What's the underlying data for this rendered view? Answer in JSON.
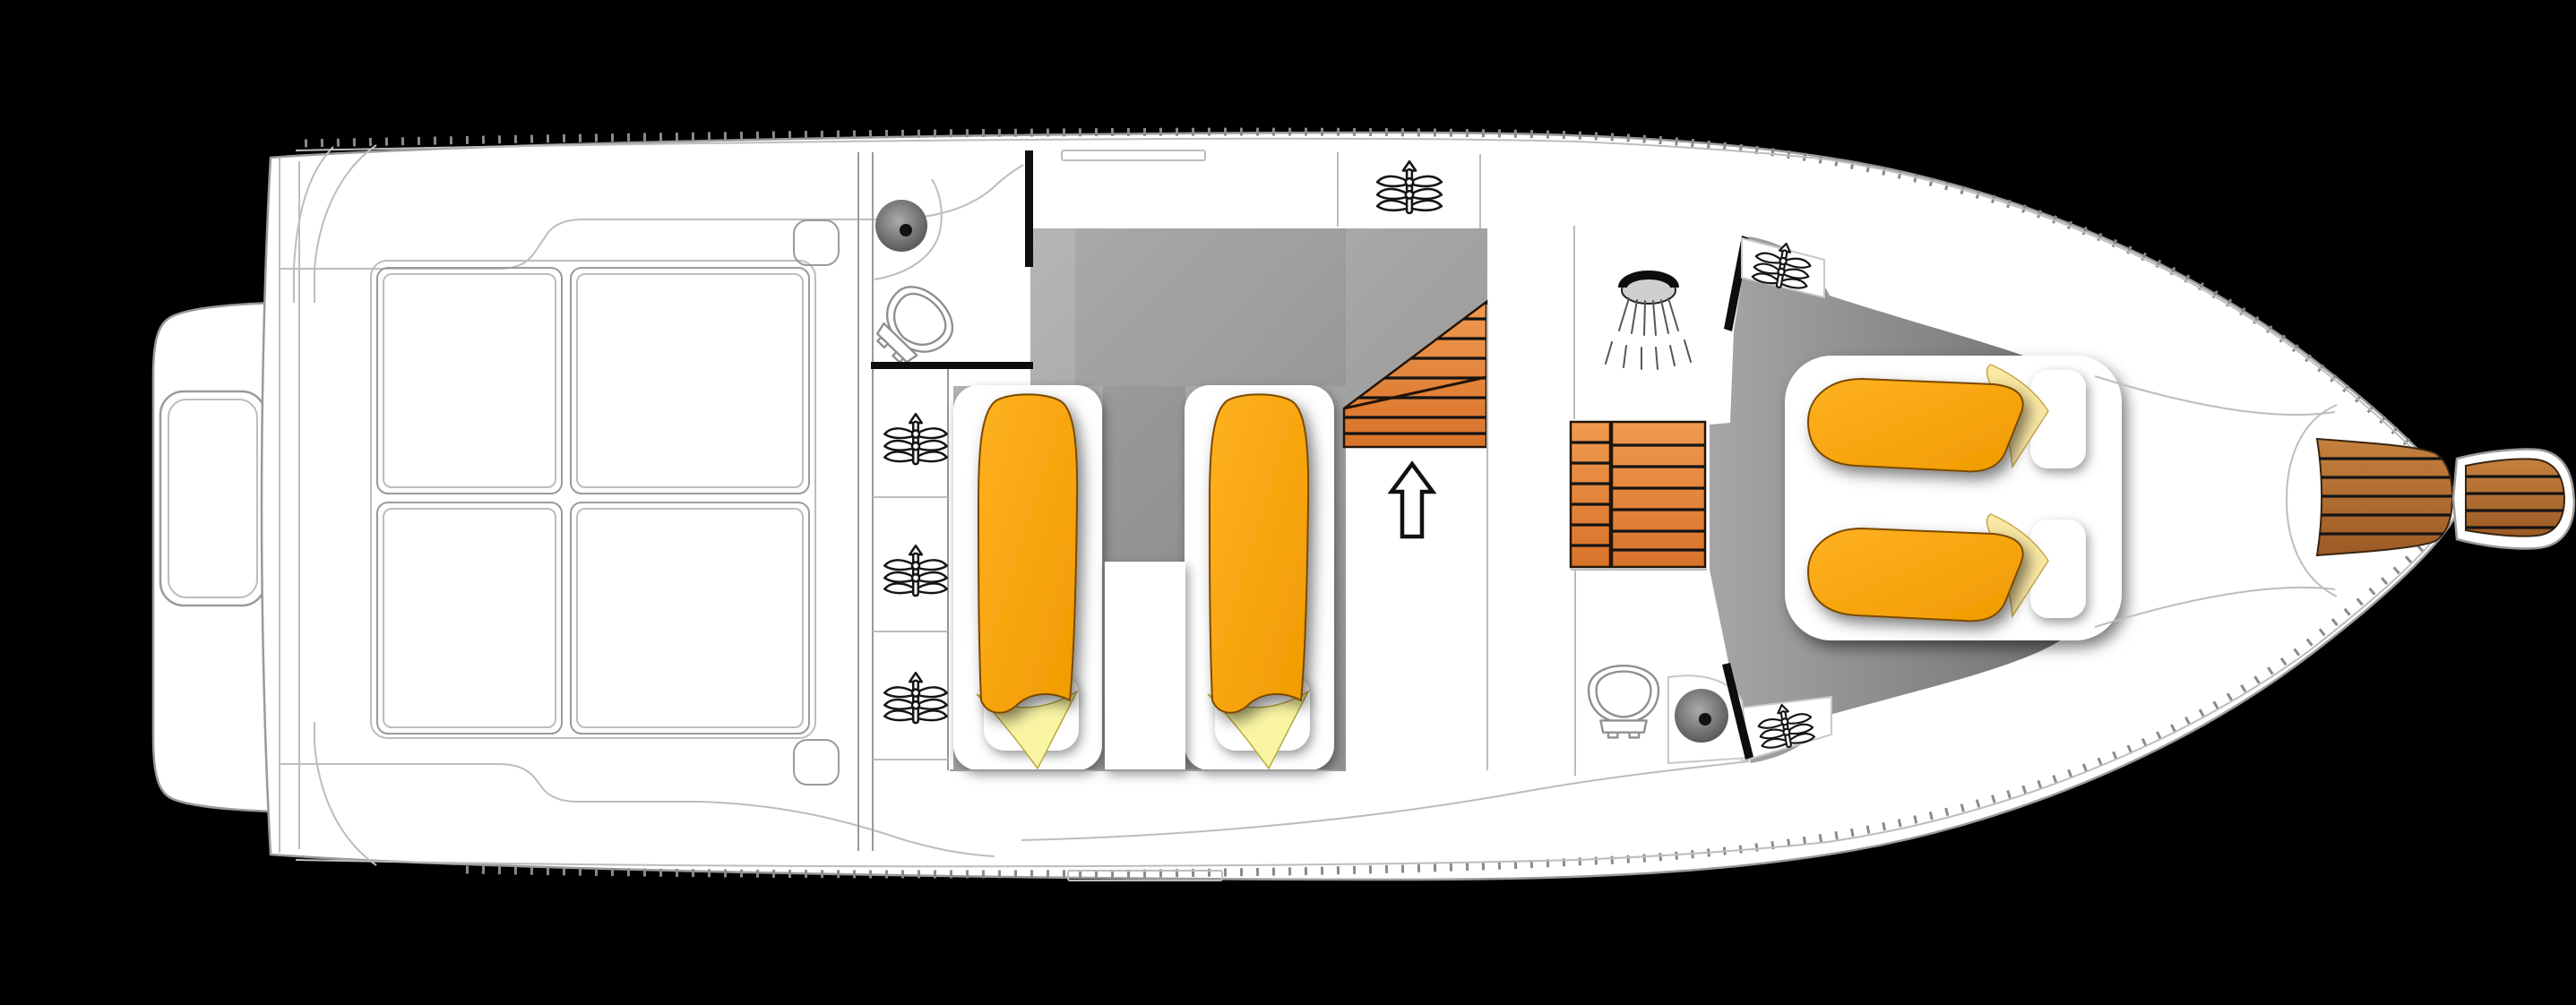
{
  "diagram": {
    "type": "boat-floor-plan",
    "orientation": "bow-right-stern-left",
    "background": "black",
    "text_labels": []
  },
  "colors": {
    "background": "#000000",
    "hull": "#ffffff",
    "line": "#bdbdbd",
    "line_mid": "#9a9a9a",
    "line_strong": "#777777",
    "wall": "#0d0d0d",
    "floor_a": "#b9b9b9",
    "floor_b": "#8c8c8c",
    "bow_floor_a": "#a6a6a6",
    "bow_floor_b": "#6e6e6e",
    "orange_a": "#ffb120",
    "orange_b": "#f09b00",
    "orange_edge": "#7a4a00",
    "yellow_mid": "#faf5a3",
    "yellow_bow": "#fbe8a4",
    "stair_a": "#f09a50",
    "stair_b": "#d8722a",
    "teak_a": "#c5803e",
    "teak_b": "#9c5a25",
    "plank": "#141414",
    "icon": "#141414",
    "sink_a": "#ababab",
    "sink_b": "#454545"
  },
  "icons": [
    "plant-icon",
    "shower-head-icon",
    "toilet-icon",
    "sink-icon",
    "up-arrow-icon"
  ],
  "inventory": {
    "sunpad_cushions": 4,
    "mid_cabin_single_berths": 2,
    "bow_cabin_berths": 2,
    "plants": 6,
    "toilets": 2,
    "basins": 2,
    "shower_heads": 1,
    "staircases": 2,
    "direction_arrows": 1,
    "teak_deck_areas": 3,
    "swim_platform_tabs": 1
  }
}
